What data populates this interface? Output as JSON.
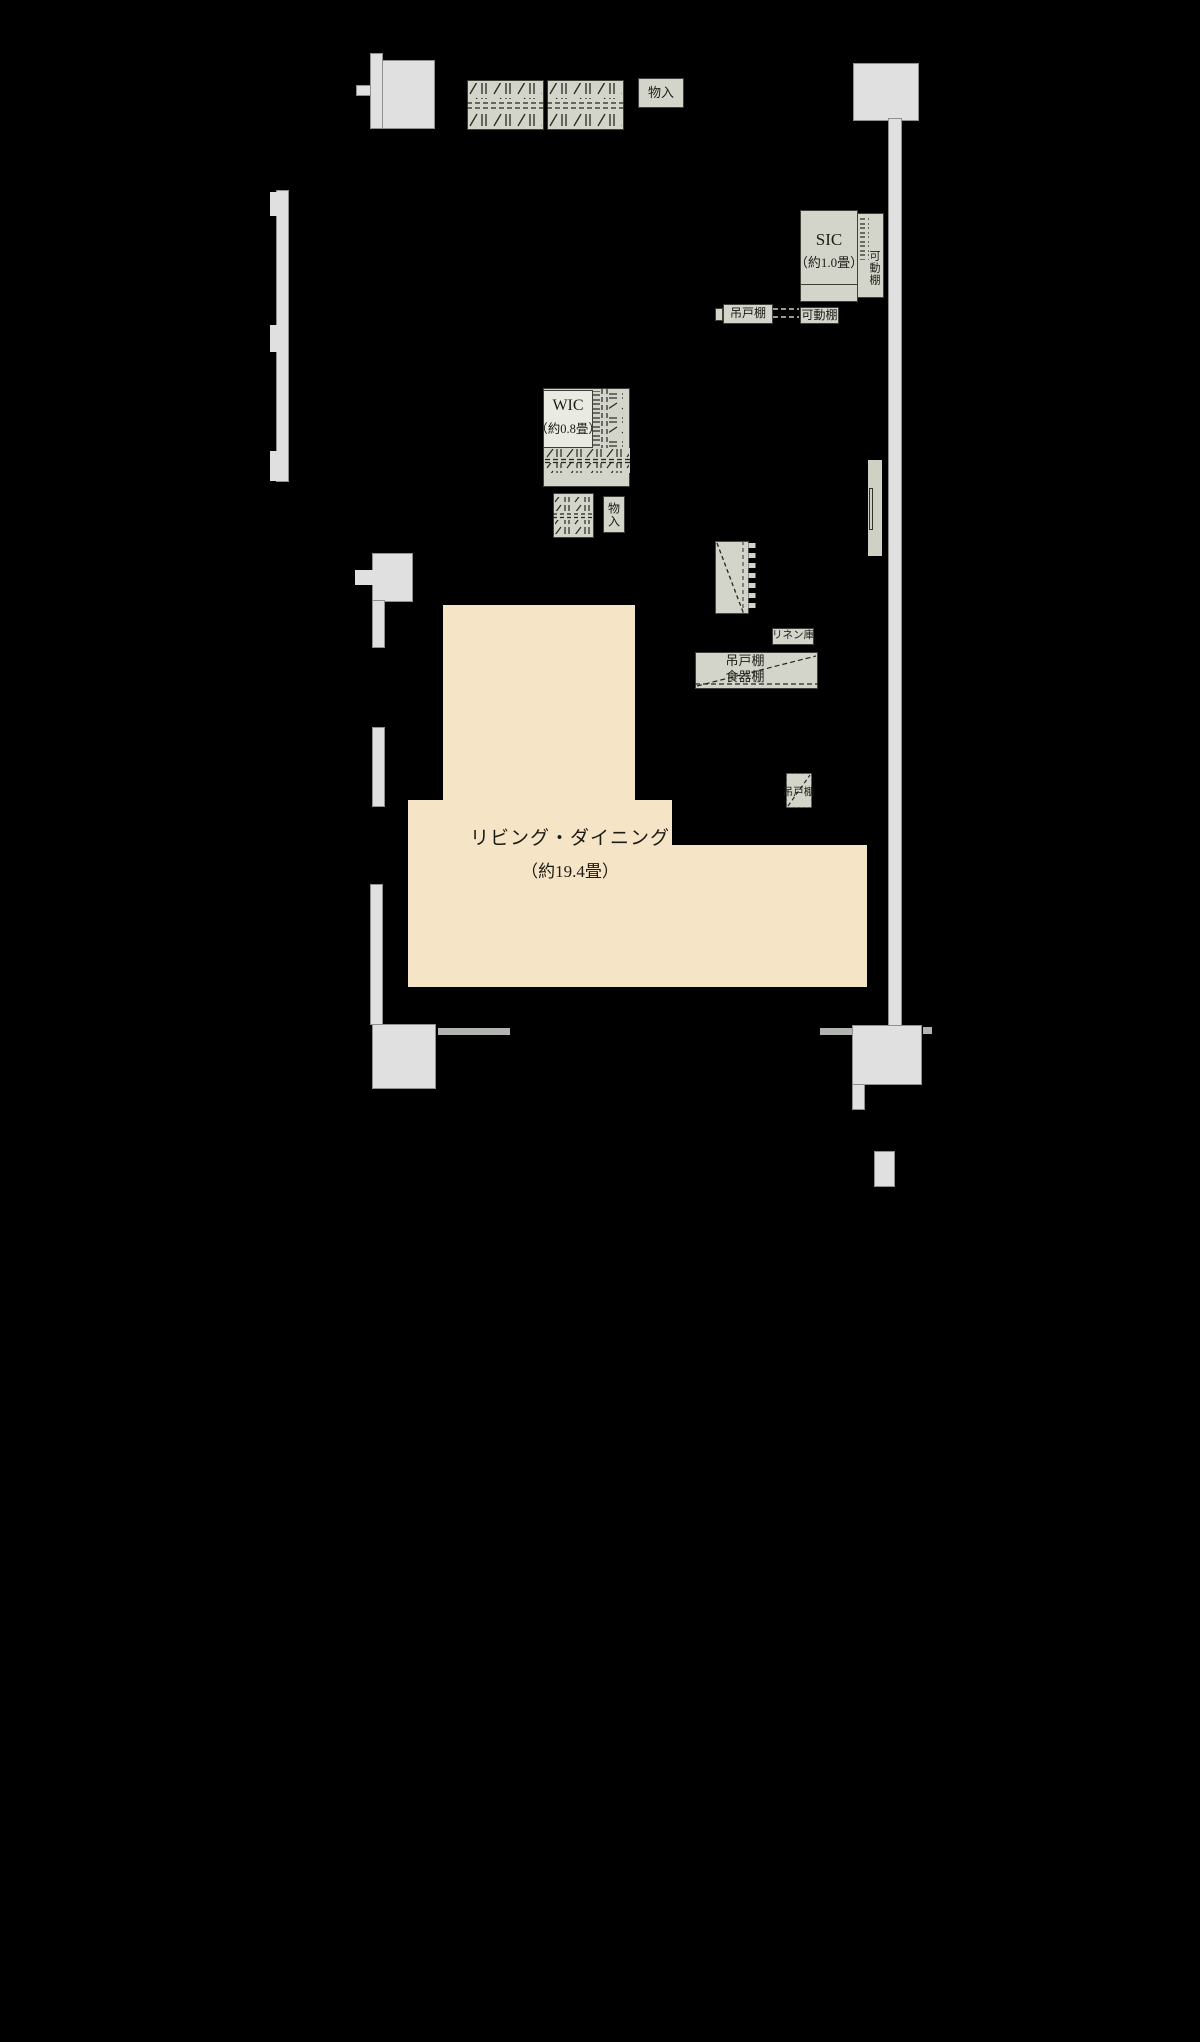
{
  "floorplan": {
    "colors": {
      "background": "#000000",
      "wall": "#dfe0df",
      "furniture": "#d3d5cb",
      "room_floor": "#f6e4c6",
      "accent_strip": "#b1b4b1"
    },
    "rooms": {
      "living_dining": {
        "name": "リビング・ダイニング",
        "size": "（約19.4畳）"
      },
      "sic": {
        "name": "SIC",
        "size": "（約1.0畳）"
      },
      "wic": {
        "name": "WIC",
        "size": "（約0.8畳）"
      }
    },
    "labels": {
      "storage_top": "物入",
      "storage_mid": "物入",
      "movable_shelf_vertical": "可動棚",
      "movable_shelf_box": "可動棚",
      "hanging_cupboard_hall": "吊戸棚",
      "linen_closet": "リネン庫",
      "hanging_cupboard_kitchen": "吊戸棚",
      "dish_cabinet": "食器棚",
      "hanging_cupboard_small": "吊戸棚"
    }
  }
}
